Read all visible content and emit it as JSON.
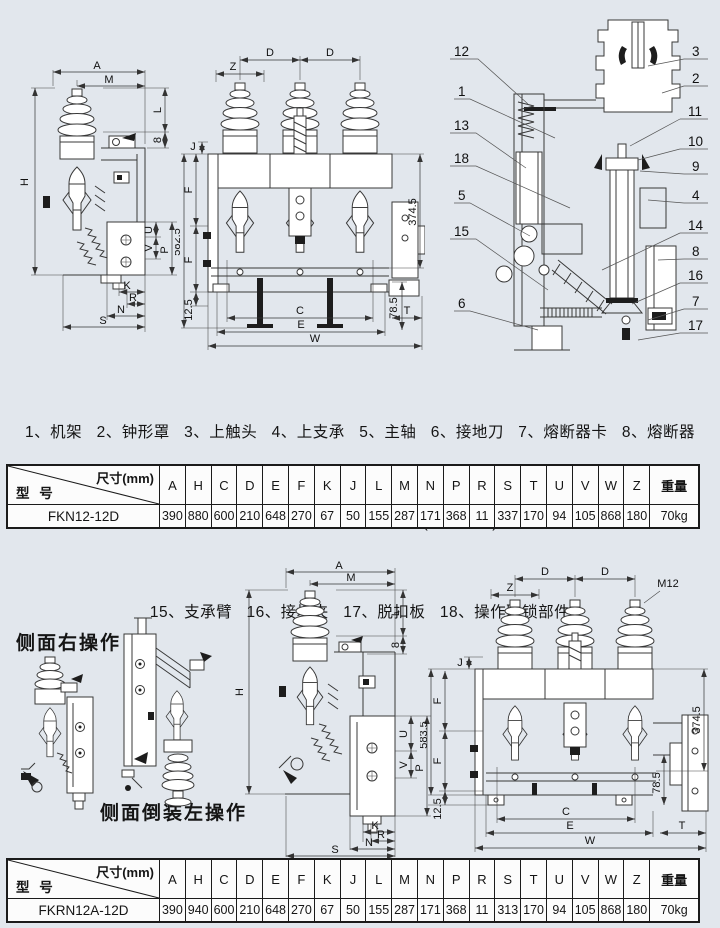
{
  "legend": {
    "line1": "1、机架   2、钟形罩   3、上触头   4、上支承   5、主轴   6、接地刀   7、熔断器卡   8、熔断器",
    "line2": "9、下触头   10、活塞   11、喷口及导电气筒   12、活门(安全档板)   13、储能机构   14、拔杆",
    "line3": "15、支承臂   16、接地夹   17、脱扣板   18、操作联锁部件"
  },
  "section_labels": {
    "side_right": "侧面右操作",
    "side_inverted_left": "侧面倒装左操作"
  },
  "drawings": {
    "side_top": {
      "dims": [
        "A",
        "M",
        "L",
        "8",
        "H",
        "U",
        "V",
        "P",
        "K",
        "R",
        "N",
        "S"
      ]
    },
    "front_top": {
      "dims": [
        "D",
        "D",
        "Z",
        "J",
        "582.5",
        "F",
        "F",
        "12.5",
        "374.5",
        "C",
        "E",
        "W",
        "78.5",
        "T"
      ]
    },
    "section": {
      "left_callouts": [
        "12",
        "1",
        "13",
        "18",
        "5",
        "15",
        "6"
      ],
      "right_callouts": [
        "3",
        "2",
        "11",
        "10",
        "9",
        "4",
        "14",
        "8",
        "16",
        "7",
        "17"
      ]
    },
    "side_bottom": {
      "dims": [
        "A",
        "M",
        "L",
        "8",
        "H",
        "U",
        "V",
        "P",
        "K",
        "R",
        "N",
        "S"
      ]
    },
    "front_bottom": {
      "dims": [
        "D",
        "D",
        "Z",
        "M12",
        "J",
        "583.5",
        "F",
        "F",
        "12.5",
        "374.5",
        "78.5",
        "C",
        "E",
        "T",
        "W"
      ]
    }
  },
  "tables": [
    {
      "corner_top": "尺寸(mm)",
      "corner_bottom": "型 号",
      "columns": [
        "A",
        "H",
        "C",
        "D",
        "E",
        "F",
        "K",
        "J",
        "L",
        "M",
        "N",
        "P",
        "R",
        "S",
        "T",
        "U",
        "V",
        "W",
        "Z",
        "重量"
      ],
      "model": "FKN12-12D",
      "values": [
        "390",
        "880",
        "600",
        "210",
        "648",
        "270",
        "67",
        "50",
        "155",
        "287",
        "171",
        "368",
        "11",
        "337",
        "170",
        "94",
        "105",
        "868",
        "180",
        "70kg"
      ]
    },
    {
      "corner_top": "尺寸(mm)",
      "corner_bottom": "型 号",
      "columns": [
        "A",
        "H",
        "C",
        "D",
        "E",
        "F",
        "K",
        "J",
        "L",
        "M",
        "N",
        "P",
        "R",
        "S",
        "T",
        "U",
        "V",
        "W",
        "Z",
        "重量"
      ],
      "model": "FKRN12A-12D",
      "values": [
        "390",
        "940",
        "600",
        "210",
        "648",
        "270",
        "67",
        "50",
        "155",
        "287",
        "171",
        "368",
        "11",
        "313",
        "170",
        "94",
        "105",
        "868",
        "180",
        "70kg"
      ]
    }
  ]
}
